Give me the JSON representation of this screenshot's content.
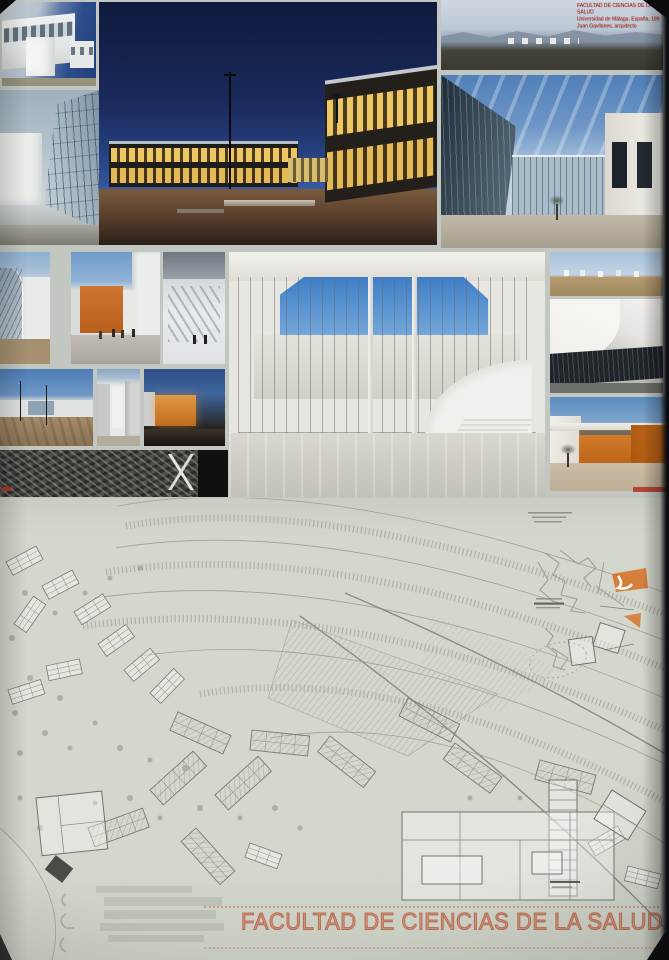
{
  "credit": {
    "line1": "FACULTAD DE CIENCIAS DE LA SALUD",
    "line2": "Universidad de Málaga, España, 199",
    "line3": "Juan Gavilanes, arquitecto"
  },
  "title": {
    "text": "FACULTAD DE CIENCIAS DE LA SALUD"
  },
  "palette": {
    "paper": "#d3d7cc",
    "mat": "#c3c7c1",
    "title_orange": "#c4745a",
    "credit_red": "#a5281e",
    "accent_orange": "#d5752c",
    "dusk_blue": "#1d2f60",
    "window_glow": "#e3b64e",
    "rubble_dark": "#3e3e3b"
  },
  "photos": [
    {
      "name": "white-building-day",
      "subject": "white building with ribbon windows, daylight"
    },
    {
      "name": "glass-curtain-wall",
      "subject": "glass curtain wall and white volume"
    },
    {
      "name": "dusk-courtyard",
      "subject": "dusk courtyard with illuminated glazed facades"
    },
    {
      "name": "arid-landscape",
      "subject": "arid landscape with distant campus and mountains"
    },
    {
      "name": "glazed-courtyard-tree",
      "subject": "glazed courtyard with small tree"
    },
    {
      "name": "curved-glass-detail",
      "subject": "curved glass wall detail"
    },
    {
      "name": "orange-street-view",
      "subject": "orange building along pedestrian street"
    },
    {
      "name": "interior-ramp",
      "subject": "interior ramp with people"
    },
    {
      "name": "campus-dirt-ground",
      "subject": "campus buildings over unpaved ground"
    },
    {
      "name": "white-alley",
      "subject": "white alley between buildings"
    },
    {
      "name": "orange-facade-dusk",
      "subject": "orange facade glowing at dusk"
    },
    {
      "name": "rubble-aerial",
      "subject": "dark aerial rubble site photo"
    },
    {
      "name": "atrium-render",
      "subject": "white atrium render with curved stair"
    },
    {
      "name": "pavilions-field",
      "subject": "white pavilions in arid field"
    },
    {
      "name": "ceiling-detail",
      "subject": "white curved ceiling interior detail"
    },
    {
      "name": "orange-courtyard-render",
      "subject": "orange courtyard with tree"
    }
  ]
}
